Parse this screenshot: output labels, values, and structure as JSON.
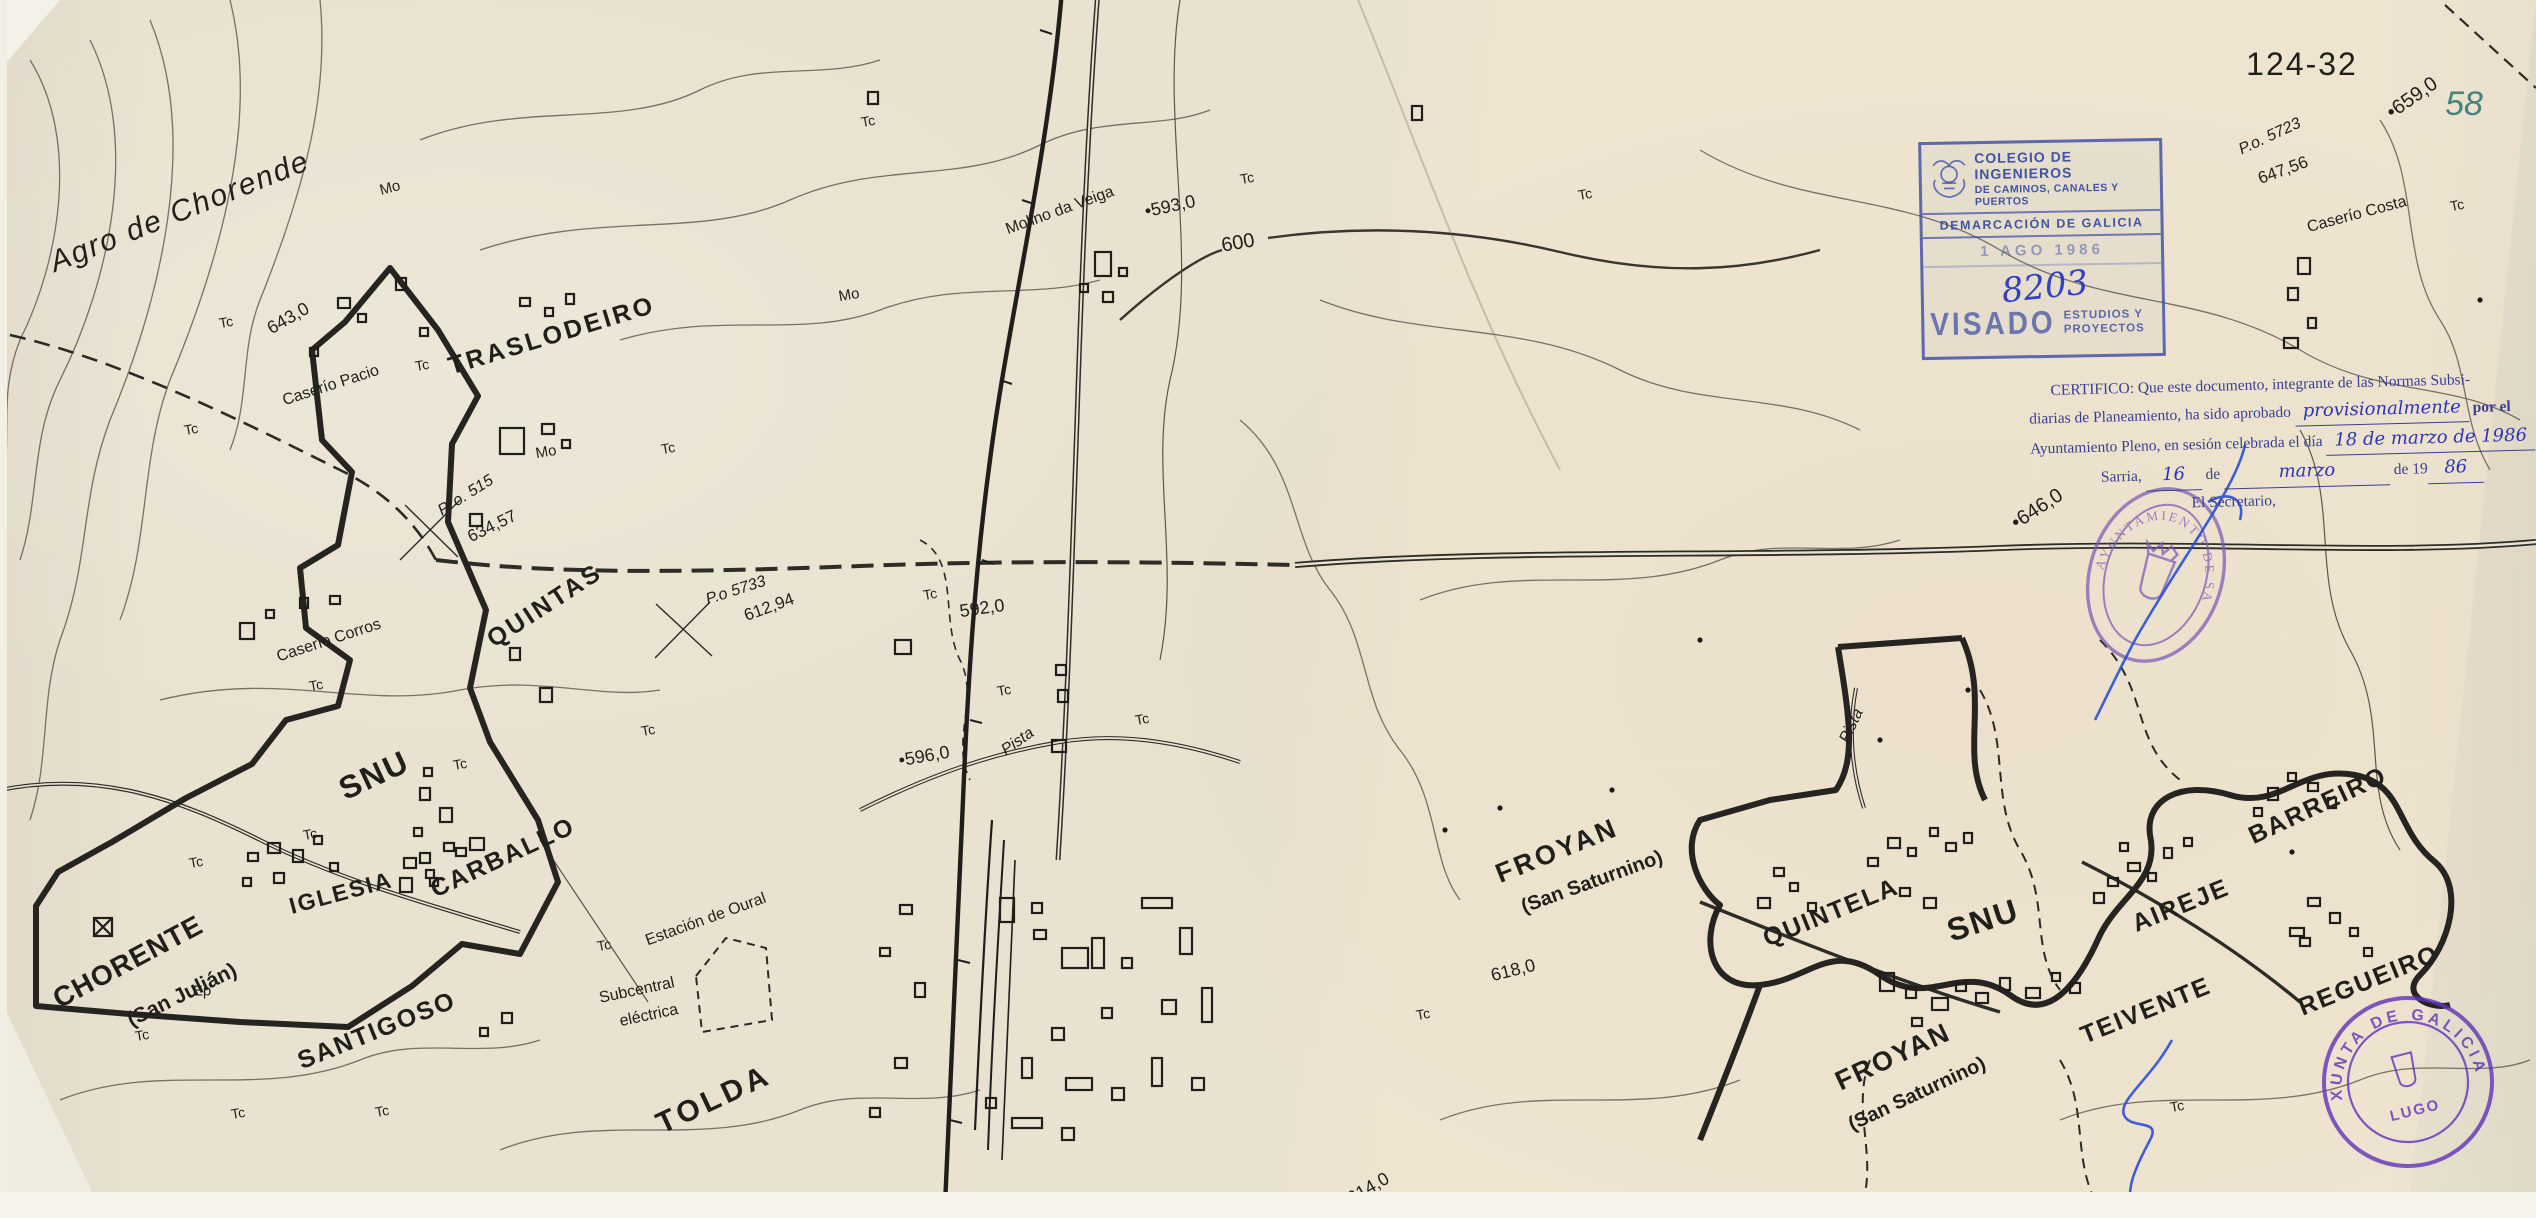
{
  "sheet": {
    "number": "124-32",
    "page_mark": "58"
  },
  "colegio_stamp": {
    "line1": "COLEGIO DE INGENIEROS",
    "line2": "DE CAMINOS, CANALES Y PUERTOS",
    "line3": "DEMARCACIÓN DE GALICIA",
    "date": "1 AGO 1986",
    "number": "8203",
    "visado": "VISADO",
    "visado_side1": "ESTUDIOS Y",
    "visado_side2": "PROYECTOS"
  },
  "certificate": {
    "l1": "CERTIFICO: Que este documento, integrante de las Normas Subsi-",
    "l2a": "diarias de Planeamiento, ha sido aprobado",
    "l2_hand": "provisionalmente",
    "l2b": "por el",
    "l3a": "Ayuntamiento Pleno, en sesión celebrada el día",
    "l3_hand": "18 de marzo de 1986",
    "l4a": "Sarria,",
    "l4_hand1": "16",
    "l4b": "de",
    "l4_hand2": "marzo",
    "l4c": "de 19",
    "l4_hand3": "86",
    "l5": "El Secretario,"
  },
  "ayuntamiento_stamp": {
    "arc": "AYUNTAMIENTO DE SARRIA"
  },
  "xunta_stamp": {
    "arc": "XUNTA DE GALICIA",
    "center": "LUGO"
  },
  "labels": [
    {
      "text": "Agro de Chorende",
      "x": 180,
      "y": 212,
      "r": -22,
      "s": 30,
      "w": 400,
      "it": true,
      "ls": 2
    },
    {
      "text": "TRASLODEIRO",
      "x": 552,
      "y": 336,
      "r": -17,
      "s": 25,
      "w": 700,
      "ls": 3
    },
    {
      "text": "QUINTAS",
      "x": 545,
      "y": 606,
      "r": -33,
      "s": 25,
      "w": 700,
      "ls": 3
    },
    {
      "text": "SNU",
      "x": 374,
      "y": 775,
      "r": -25,
      "s": 32,
      "w": 700,
      "ls": 2
    },
    {
      "text": "CHORENTE",
      "x": 128,
      "y": 962,
      "r": -28,
      "s": 28,
      "w": 700,
      "ls": 1
    },
    {
      "text": "(San Julián)",
      "x": 182,
      "y": 995,
      "r": -26,
      "s": 21,
      "w": 700
    },
    {
      "text": "IGLESIA",
      "x": 341,
      "y": 893,
      "r": -15,
      "s": 23,
      "w": 700,
      "ls": 2
    },
    {
      "text": "SANTIGOSO",
      "x": 377,
      "y": 1031,
      "r": -22,
      "s": 25,
      "w": 700,
      "ls": 2
    },
    {
      "text": "CARBALLO",
      "x": 503,
      "y": 858,
      "r": -25,
      "s": 25,
      "w": 700,
      "ls": 2
    },
    {
      "text": "TOLDA",
      "x": 714,
      "y": 1100,
      "r": -25,
      "s": 30,
      "w": 700,
      "ls": 4
    },
    {
      "text": "FROYAN",
      "x": 1557,
      "y": 851,
      "r": -22,
      "s": 27,
      "w": 700,
      "ls": 3
    },
    {
      "text": "(San Saturnino)",
      "x": 1592,
      "y": 882,
      "r": -20,
      "s": 20,
      "w": 700
    },
    {
      "text": "QUINTELA",
      "x": 1831,
      "y": 913,
      "r": -22,
      "s": 25,
      "w": 700,
      "ls": 2
    },
    {
      "text": "SNU",
      "x": 1983,
      "y": 920,
      "r": -18,
      "s": 32,
      "w": 700,
      "ls": 2
    },
    {
      "text": "AIREJE",
      "x": 2181,
      "y": 906,
      "r": -22,
      "s": 25,
      "w": 700,
      "ls": 2
    },
    {
      "text": "BARREIRO",
      "x": 2318,
      "y": 806,
      "r": -25,
      "s": 25,
      "w": 700,
      "ls": 2
    },
    {
      "text": "TEIVENTE",
      "x": 2146,
      "y": 1011,
      "r": -22,
      "s": 25,
      "w": 700,
      "ls": 2
    },
    {
      "text": "REGUEIRO",
      "x": 2369,
      "y": 981,
      "r": -22,
      "s": 25,
      "w": 700,
      "ls": 2
    },
    {
      "text": "FROYAN",
      "x": 1893,
      "y": 1057,
      "r": -25,
      "s": 27,
      "w": 700,
      "ls": 2
    },
    {
      "text": "(San Saturnino)",
      "x": 1917,
      "y": 1094,
      "r": -25,
      "s": 20,
      "w": 700
    },
    {
      "text": "Caserío Pacio",
      "x": 331,
      "y": 386,
      "r": -18,
      "s": 16
    },
    {
      "text": "Caserío Corros",
      "x": 329,
      "y": 641,
      "r": -18,
      "s": 16
    },
    {
      "text": "Caserío Costa",
      "x": 2357,
      "y": 215,
      "r": -15,
      "s": 16
    },
    {
      "text": "Molino da Veiga",
      "x": 1060,
      "y": 211,
      "r": -20,
      "s": 16
    },
    {
      "text": "Estación de Oural",
      "x": 706,
      "y": 920,
      "r": -20,
      "s": 16
    },
    {
      "text": "Subcentral",
      "x": 637,
      "y": 991,
      "r": -12,
      "s": 16
    },
    {
      "text": "eléctrica",
      "x": 649,
      "y": 1016,
      "r": -12,
      "s": 16
    },
    {
      "text": "Pista",
      "x": 1018,
      "y": 742,
      "r": -35,
      "s": 16,
      "it": true
    },
    {
      "text": "Pista",
      "x": 1852,
      "y": 726,
      "r": -65,
      "s": 16,
      "it": true
    },
    {
      "text": "643,0",
      "x": 288,
      "y": 318,
      "r": -30,
      "s": 18
    },
    {
      "text": "•593,0",
      "x": 1170,
      "y": 206,
      "r": -12,
      "s": 18
    },
    {
      "text": "592,0",
      "x": 982,
      "y": 608,
      "r": -8,
      "s": 18
    },
    {
      "text": "•596,0",
      "x": 924,
      "y": 756,
      "r": -10,
      "s": 18
    },
    {
      "text": "618,0",
      "x": 1513,
      "y": 970,
      "r": -14,
      "s": 18
    },
    {
      "text": "614,0",
      "x": 1368,
      "y": 1188,
      "r": -30,
      "s": 18
    },
    {
      "text": "•646,0",
      "x": 2037,
      "y": 509,
      "r": -33,
      "s": 20
    },
    {
      "text": "•659,0",
      "x": 2412,
      "y": 98,
      "r": -35,
      "s": 20
    },
    {
      "text": "600",
      "x": 1238,
      "y": 243,
      "r": -10,
      "s": 20
    },
    {
      "text": "634,57",
      "x": 492,
      "y": 526,
      "r": -26,
      "s": 17
    },
    {
      "text": "612,94",
      "x": 769,
      "y": 607,
      "r": -20,
      "s": 17
    },
    {
      "text": "647,56",
      "x": 2283,
      "y": 170,
      "r": -20,
      "s": 17
    },
    {
      "text": "P. o. 515",
      "x": 466,
      "y": 496,
      "r": -32,
      "s": 16,
      "it": true
    },
    {
      "text": "P.o 5733",
      "x": 736,
      "y": 591,
      "r": -18,
      "s": 16,
      "it": true
    },
    {
      "text": "P.o. 5723",
      "x": 2270,
      "y": 137,
      "r": -25,
      "s": 16,
      "it": true
    },
    {
      "text": "124-32",
      "x": 2302,
      "y": 64,
      "r": 0,
      "s": 32,
      "ls": 2,
      "w": 500
    },
    {
      "text": "58",
      "x": 2464,
      "y": 104,
      "r": 0,
      "s": 34,
      "c": "#46837c",
      "it": true
    },
    {
      "text": "Ep",
      "x": 202,
      "y": 991,
      "r": 0,
      "s": 15
    },
    {
      "text": "Mo",
      "x": 390,
      "y": 188,
      "r": -15,
      "s": 15
    },
    {
      "text": "Mo",
      "x": 546,
      "y": 452,
      "r": -10,
      "s": 15
    },
    {
      "text": "Mo",
      "x": 849,
      "y": 295,
      "r": -10,
      "s": 15
    },
    {
      "text": "Tc",
      "x": 226,
      "y": 322,
      "r": -10,
      "s": 14
    },
    {
      "text": "Tc",
      "x": 422,
      "y": 365,
      "r": -10,
      "s": 14
    },
    {
      "text": "Tc",
      "x": 668,
      "y": 448,
      "r": -10,
      "s": 14
    },
    {
      "text": "Tc",
      "x": 316,
      "y": 685,
      "r": -10,
      "s": 14
    },
    {
      "text": "Tc",
      "x": 460,
      "y": 764,
      "r": -10,
      "s": 14
    },
    {
      "text": "Tc",
      "x": 648,
      "y": 730,
      "r": -10,
      "s": 14
    },
    {
      "text": "Tc",
      "x": 196,
      "y": 862,
      "r": -10,
      "s": 14
    },
    {
      "text": "Tc",
      "x": 310,
      "y": 834,
      "r": -10,
      "s": 14
    },
    {
      "text": "Tc",
      "x": 191,
      "y": 429,
      "r": -10,
      "s": 14
    },
    {
      "text": "Tc",
      "x": 142,
      "y": 1035,
      "r": -10,
      "s": 14
    },
    {
      "text": "Tc",
      "x": 238,
      "y": 1113,
      "r": -10,
      "s": 14
    },
    {
      "text": "Tc",
      "x": 382,
      "y": 1111,
      "r": -10,
      "s": 14
    },
    {
      "text": "Tc",
      "x": 604,
      "y": 945,
      "r": -10,
      "s": 14
    },
    {
      "text": "Tc",
      "x": 930,
      "y": 594,
      "r": -10,
      "s": 14
    },
    {
      "text": "Tc",
      "x": 1004,
      "y": 690,
      "r": -10,
      "s": 14
    },
    {
      "text": "Tc",
      "x": 1142,
      "y": 719,
      "r": -10,
      "s": 14
    },
    {
      "text": "Tc",
      "x": 1247,
      "y": 178,
      "r": -10,
      "s": 14
    },
    {
      "text": "Tc",
      "x": 868,
      "y": 121,
      "r": -10,
      "s": 14
    },
    {
      "text": "Tc",
      "x": 1585,
      "y": 194,
      "r": -10,
      "s": 14
    },
    {
      "text": "Tc",
      "x": 1423,
      "y": 1014,
      "r": -10,
      "s": 14
    },
    {
      "text": "Tc",
      "x": 2457,
      "y": 205,
      "r": -10,
      "s": 14
    },
    {
      "text": "Tc",
      "x": 2177,
      "y": 1106,
      "r": -10,
      "s": 14
    }
  ]
}
